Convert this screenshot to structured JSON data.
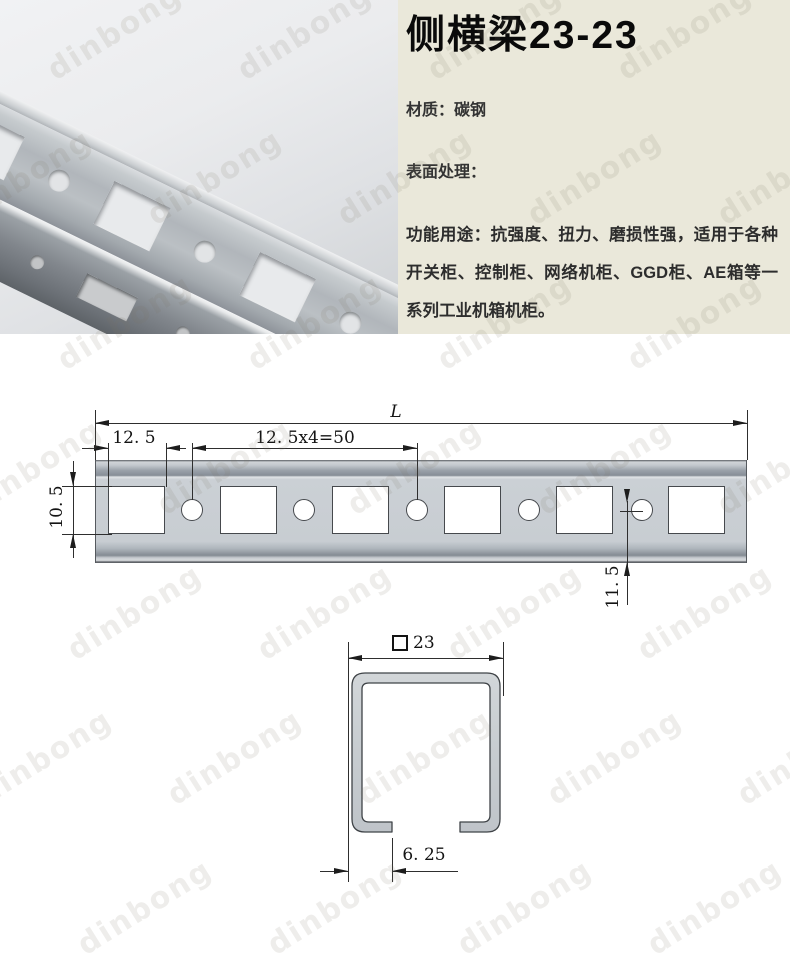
{
  "panel": {
    "title": "侧横梁23-23",
    "material": "材质：碳钢",
    "surface": "表面处理：",
    "usage": "功能用途：抗强度、扭力、磨损性强，适用于各种开关柜、控制柜、网络机柜、GGD柜、AE箱等一系列工业机箱机柜。"
  },
  "drawing": {
    "overall_length": "L",
    "end_offset": "12. 5",
    "hole_pitch": "12. 5x4=50",
    "hole_height": "10. 5",
    "hole_to_edge": "11. 5",
    "section_size": "23",
    "lip_width": "6. 25"
  },
  "watermark": {
    "text": "dinbong"
  },
  "colors": {
    "panel_bg": "#eae8da",
    "metal_fill": "#c9ced2",
    "drawing_line": "#2e2e2e"
  }
}
